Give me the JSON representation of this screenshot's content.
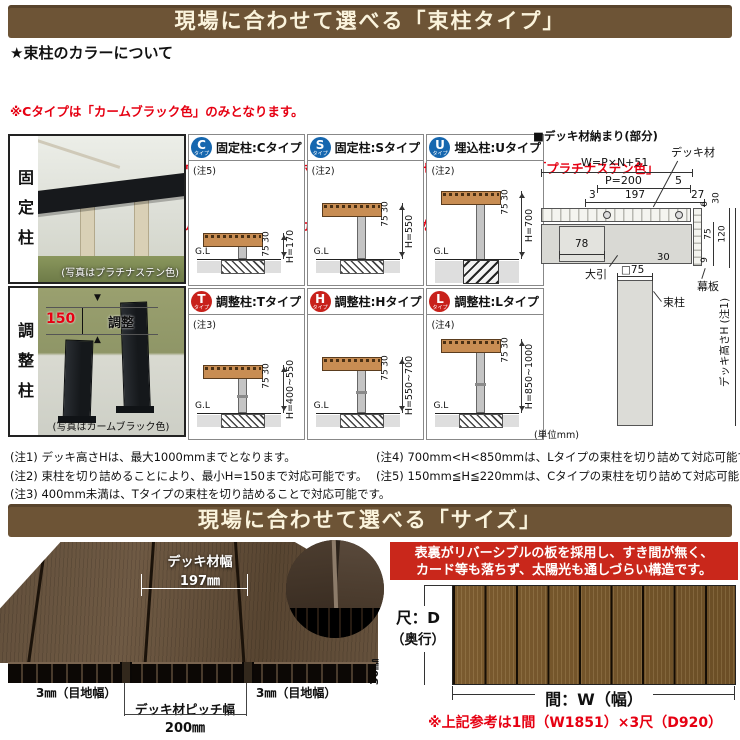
{
  "banner_tsukabashira": {
    "title": "現場に合わせて選べる「束柱タイプ」",
    "bg": "#6d5436",
    "fg": "#faf3dc"
  },
  "color_info": {
    "heading": "★束柱のカラーについて",
    "color": "#e60012",
    "lines": [
      "※Cタイプは「カームブラック色」のみとなります。",
      "※その他のタイプはデッキ材がウォームグレイ色・ホワイトブラウン色・セピアグレイ色では「プラチナステン色」",
      "　レッドブラウン色・ナチュラルブラウン色では「カームブラック色」となります。"
    ]
  },
  "photo_panel": {
    "fixed": {
      "label": "固定柱",
      "caption": "(写真はプラチナステン色)"
    },
    "adjustable": {
      "label": "調整柱",
      "caption": "(写真はカームブラック色)",
      "dim_value": "150",
      "dim_text": "調整"
    }
  },
  "type_grid": {
    "badge_colors": {
      "fixed": "#1667af",
      "adjustable": "#c8211b"
    },
    "cells": [
      {
        "badge": "C",
        "badge_sub": "タイプ",
        "title": "固定柱:Cタイプ",
        "note": "(注5)",
        "gl": "G.L",
        "thickness": "30",
        "joist": "75",
        "height": "H=170"
      },
      {
        "badge": "S",
        "badge_sub": "タイプ",
        "title": "固定柱:Sタイプ",
        "note": "(注2)",
        "gl": "G.L",
        "thickness": "30",
        "joist": "75",
        "height": "H=550"
      },
      {
        "badge": "U",
        "badge_sub": "タイプ",
        "title": "埋込柱:Uタイプ",
        "note": "(注2)",
        "gl": "G.L",
        "thickness": "30",
        "joist": "75",
        "height": "H=700"
      },
      {
        "badge": "T",
        "badge_sub": "タイプ",
        "title": "調整柱:Tタイプ",
        "note": "(注3)",
        "gl": "G.L",
        "thickness": "30",
        "joist": "75",
        "height": "H=400~550"
      },
      {
        "badge": "H",
        "badge_sub": "タイプ",
        "title": "調整柱:Hタイプ",
        "note": "",
        "gl": "G.L",
        "thickness": "30",
        "joist": "75",
        "height": "H=550~700"
      },
      {
        "badge": "L",
        "badge_sub": "タイプ",
        "title": "調整柱:Lタイプ",
        "note": "(注4)",
        "gl": "G.L",
        "thickness": "30",
        "joist": "75",
        "height": "H=850~1000"
      }
    ],
    "unit": "(単位mm)"
  },
  "detail_diagram": {
    "title": "■デッキ材納まり(部分)",
    "labels": {
      "deck": "デッキ材",
      "joist": "大引",
      "fascia": "幕板",
      "post": "束柱",
      "post_size": "□75",
      "height": "デッキ高さH (注1)"
    },
    "dims": {
      "w": "W=P×N+51",
      "p": "P=200",
      "gap5": "5",
      "gap3": "3",
      "board": "197",
      "d27": "27",
      "d6": "6",
      "d30_top": "30",
      "d120": "120",
      "d75": "75",
      "d78": "78",
      "d30_bottom": "30",
      "d9": "9"
    }
  },
  "notes": {
    "left": [
      "(注1) デッキ高さHは、最大1000mmまでとなります。",
      "(注2) 束柱を切り詰めることにより、最小H=150まで対応可能です。",
      "(注3) 400mm未満は、Tタイプの束柱を切り詰めることで対応可能です。"
    ],
    "right": [
      "(注4) 700mm<H<850mmは、Lタイプの束柱を切り詰めて対応可能です。",
      "(注5) 150mm≦H≦220mmは、Cタイプの束柱を切り詰めて対応可能です。"
    ]
  },
  "banner_size": {
    "title": "現場に合わせて選べる「サイズ」"
  },
  "size_section": {
    "deck_width": {
      "label": "デッキ材幅",
      "value": "197㎜"
    },
    "joint_left": "3㎜（目地幅）",
    "joint_right": "3㎜（目地幅）",
    "pitch": {
      "label": "デッキ材ピッチ幅",
      "value": "200㎜"
    },
    "feature_box": {
      "bg": "#c9271b",
      "lines": [
        "表裏がリバーシブルの板を採用し、すき間が無く、",
        "カード等も落ちず、太陽光も通しづらい構造です。"
      ]
    },
    "plan": {
      "depth_label": "尺：D",
      "depth_sub": "（奥行）",
      "width_label": "間：W（幅）",
      "thickness": "30㎜"
    },
    "reference": "※上記参考は1間（W1851）×3尺（D920）"
  }
}
